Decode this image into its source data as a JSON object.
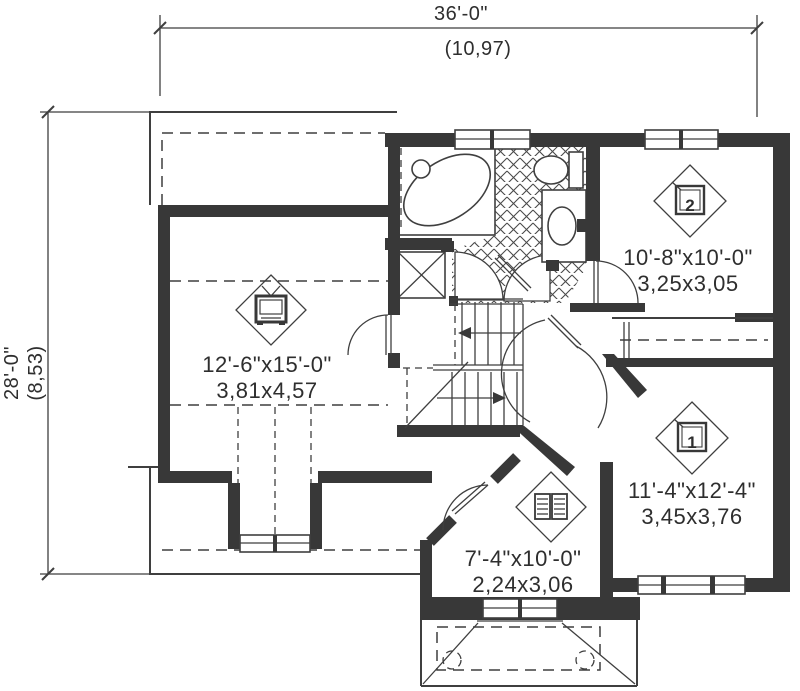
{
  "title": "Second floor plan",
  "dimensions": {
    "width": {
      "imperial": "36'-0\"",
      "metric": "(10,97)"
    },
    "height": {
      "imperial": "28'-0\"",
      "metric": "(8,53)"
    }
  },
  "rooms": {
    "tv_room": {
      "icon": "tv-icon",
      "imperial": "12'-6\"x15'-0\"",
      "metric": "3,81x4,57"
    },
    "bedroom2": {
      "icon": "bed-icon",
      "number": "2",
      "imperial": "10'-8\"x10'-0\"",
      "metric": "3,25x3,05"
    },
    "bedroom1": {
      "icon": "bed-icon",
      "number": "1",
      "imperial": "11'-4\"x12'-4\"",
      "metric": "3,45x3,76"
    },
    "study": {
      "icon": "book-icon",
      "imperial": "7'-4\"x10'-0\"",
      "metric": "2,24x3,06"
    }
  },
  "colors": {
    "wall": "#383838",
    "line": "#3f3f3f",
    "text": "#2e2e2e",
    "background": "#ffffff"
  }
}
